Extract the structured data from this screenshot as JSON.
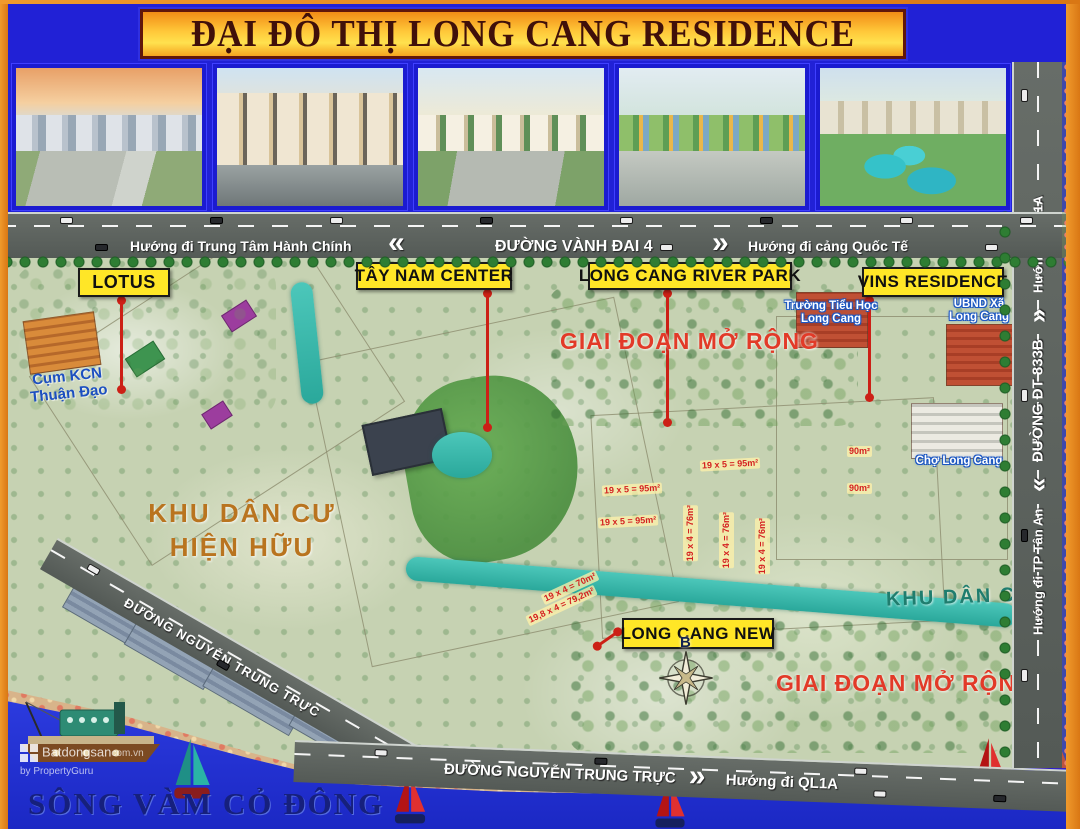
{
  "page": {
    "title": "ĐẠI ĐÔ THỊ LONG CANG RESIDENCE"
  },
  "roads": {
    "vanh_dai_4": {
      "left_hint": "Hướng đi Trung Tâm Hành Chính",
      "chevron_left": "«",
      "name": "ĐƯỜNG VÀNH ĐAI 4",
      "chevron_right": "»",
      "right_hint": "Hướng đi cảng Quốc Tế"
    },
    "dt_833b": {
      "bottom_hint": "Hướng đi TP Tân An",
      "chevron_down": "«",
      "name": "ĐƯỜNG ĐT 833B",
      "chevron_up": "»",
      "top_hint": "Hướng đi QL1A"
    },
    "nguyen_trung_truc": {
      "name_diagonal": "ĐƯỜNG NGUYỄN TRUNG TRỰC",
      "name": "ĐƯỜNG NGUYỄN TRUNG TRỰC",
      "chevron": "»",
      "right_hint": "Hướng đi QL1A"
    }
  },
  "zone_labels": {
    "lotus": "LOTUS",
    "tay_nam_center": "TÂY NAM CENTER",
    "river_park": "LONG CANG RIVER PARK",
    "vins_residence": "VINS RESIDENCE",
    "long_cang_new": "LONG CANG NEW"
  },
  "map_texts": {
    "expansion_top": "GIAI ĐOẠN MỞ RỘNG",
    "expansion_bottom": "GIAI ĐOẠN MỞ RỘNG",
    "school": {
      "line1": "Trường Tiểu Học",
      "line2": "Long Cang"
    },
    "ubnd": {
      "line1": "UBND Xã",
      "line2": "Long Cang"
    },
    "market": "Chợ Long Cang",
    "industrial": {
      "line1": "Cụm KCN",
      "line2": "Thuận Đạo"
    },
    "existing_residential": {
      "line1": "KHU DÂN CƯ",
      "line2": "HIỆN HỮU"
    },
    "residential_east": "KHU DÂN CƯ",
    "river": "SÔNG VÀM CỎ ĐÔNG",
    "compass_north": "B"
  },
  "plot_labels": [
    {
      "text": "19 x 5 = 95m²",
      "x": 700,
      "y": 459,
      "rot": -3
    },
    {
      "text": "19 x 5 = 95m²",
      "x": 602,
      "y": 484,
      "rot": -3
    },
    {
      "text": "19 x 5 = 95m²",
      "x": 598,
      "y": 516,
      "rot": -3
    },
    {
      "text": "90m²",
      "x": 847,
      "y": 446,
      "rot": 0
    },
    {
      "text": "90m²",
      "x": 847,
      "y": 483,
      "rot": 0
    },
    {
      "text": "19 x 4 = 76m²",
      "x": 683,
      "y": 505,
      "rot": 90
    },
    {
      "text": "19 x 4 = 76m²",
      "x": 719,
      "y": 512,
      "rot": 90
    },
    {
      "text": "19 x 4 = 76m²",
      "x": 755,
      "y": 518,
      "rot": 90
    },
    {
      "text": "19 x 4 = 70m²",
      "x": 540,
      "y": 582,
      "rot": -25
    },
    {
      "text": "19,8 x 4 = 79,2m²",
      "x": 524,
      "y": 600,
      "rot": -25
    }
  ],
  "watermark": {
    "brand": "Batdongsan",
    "domain": "com.vn",
    "byline": "by PropertyGuru"
  },
  "colors": {
    "frame_orange": "#ee8a1e",
    "header_blue": "#2121d6",
    "title_text": "#40100a",
    "label_yellow": "#ffe627",
    "road_gray": "#575d59",
    "expansion_red": "#e23a28",
    "canal_teal": "#36b8ab",
    "river_blue": "#2130d6"
  }
}
